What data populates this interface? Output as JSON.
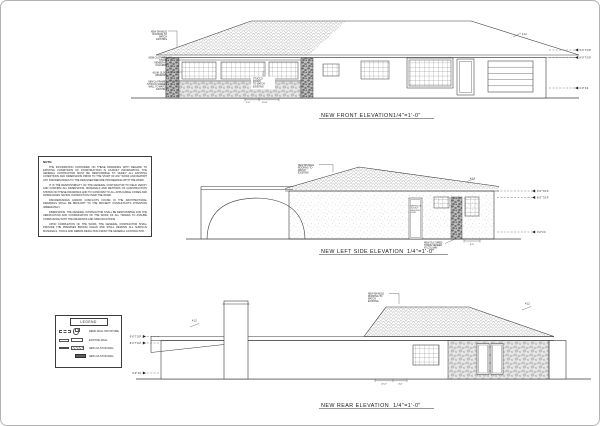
{
  "sheet": {
    "paper_color": "#ffffff",
    "ink_color": "#1a1a1a"
  },
  "front": {
    "title": "NEW FRONT ELEVATION",
    "scale": "1/4\"=1'-0\"",
    "slope": "4:12",
    "anno": {
      "roof": [
        "NEW SHINGLE",
        "ROOFING TO",
        "MATCH",
        "EXISTING"
      ],
      "stone": [
        "NEW CULTURED",
        "STONE",
        "VENEER AT",
        "COLUMNS"
      ],
      "win": [
        "ALUM. SLDG.",
        "WINDOWS"
      ],
      "screen": [
        "NEW 2x FRAMED",
        "STUCCO SCREEN",
        "WALL TO MATCH",
        "EXISTING"
      ],
      "stucco": [
        "STUCCO",
        "FINISH",
        "TO MATCH",
        "EXISTING"
      ]
    },
    "dims": {
      "d1": "3'-0\"",
      "d2": "10'-0\""
    }
  },
  "side": {
    "title": "NEW LEFT SIDE ELEVATION",
    "scale": "1/4\"=1'-0\"",
    "slope": "4:12",
    "anno": {
      "roof": [
        "NEW SHINGLE",
        "ROOFING TO",
        "MATCH",
        "EXISTING"
      ],
      "door": [
        "NEW SGL DR.",
        "3'-0\"x6'-8\"",
        "SELF-CLSG.",
        "DOOR"
      ],
      "stone": [
        "NEW CULTURED",
        "STONE VENEER",
        "AT COLUMN"
      ]
    },
    "dims": {
      "d1": "4'-0\""
    }
  },
  "rear": {
    "title": "NEW REAR ELEVATION",
    "scale": "1/4\"=1'-0\"",
    "slope_left": "4:12",
    "slope_right": "4:12",
    "anno": {
      "roof": [
        "NEW SHINGLE",
        "ROOFING TO",
        "MATCH",
        "EXISTING"
      ]
    },
    "dims": {
      "d1": "21'-0\"",
      "d2": "4'-0\""
    }
  },
  "markers": {
    "top_plate_9": "9'-0\" T.O.P.",
    "top_plate_8": "8'-0\" T.O.P.",
    "finish_floor": "0'-0\" F.F."
  },
  "notes": {
    "heading": "NOTE:",
    "paragraphs": [
      "THE INFORMATION CONTAINED ON THESE DRAWINGS WITH REGARD TO EXISTING CONDITIONS OF CONSTRUCTION IS AS-BUILT INFORMATION. THE GENERAL CONTRACTOR MUST BE RESPONSIBLE TO VERIFY ALL EXISTING CONDITIONS AND DIMENSIONS PRIOR TO THE START OF ANY WORK AND REPORT ANY DISCREPANCIES TO THE DESIGNER BEFORE PROCEEDING WITH THE WORK.",
      "IT IS THE RESPONSIBILITY OF THE GENERAL CONTRACTOR TO FIELD VERIFY AND CONFIRM ALL DIMENSIONS, MATERIALS AND METHODS OF CONSTRUCTION SHOWN ON THESE DRAWINGS AND TO CONFORM TO ALL APPLICABLE CODES AND ORDINANCES HAVING JURISDICTION OVER THE WORK.",
      "DISCREPANCIES AND/OR CONFLICTS FOUND IN THE ARCHITECTURAL DRAWINGS SHALL BE BROUGHT TO THE PROJECT CONSULTANT'S ATTENTION IMMEDIATELY.",
      "DIMENSIONS: THE GENERAL CONTRACTOR SHALL BE RESPONSIBLE FOR THE VERIFICATION AND COORDINATION OF THE WORK OF ALL TRADES TO ASSURE COMPLIANCE WITH THE DRAWINGS AND SPECIFICATIONS.",
      "UPON COMPLETION OF THE WORK, THE GENERAL CONTRACTOR SHALL PROVIDE THE PREMISES BROOM CLEAN AND SHALL REMOVE ALL SURPLUS MATERIALS, TOOLS AND DEBRIS RESULTING FROM THE GENERAL CONTRACTOR."
    ]
  },
  "legend": {
    "title": "LEGEND",
    "items": [
      {
        "label": "DEMO WALL OR FIXTURE"
      },
      {
        "label": "EXISTING WALL"
      },
      {
        "label": "NEW 2x4 STUD WALL"
      },
      {
        "label": "NEW 2x6 STUD WALL"
      }
    ]
  }
}
